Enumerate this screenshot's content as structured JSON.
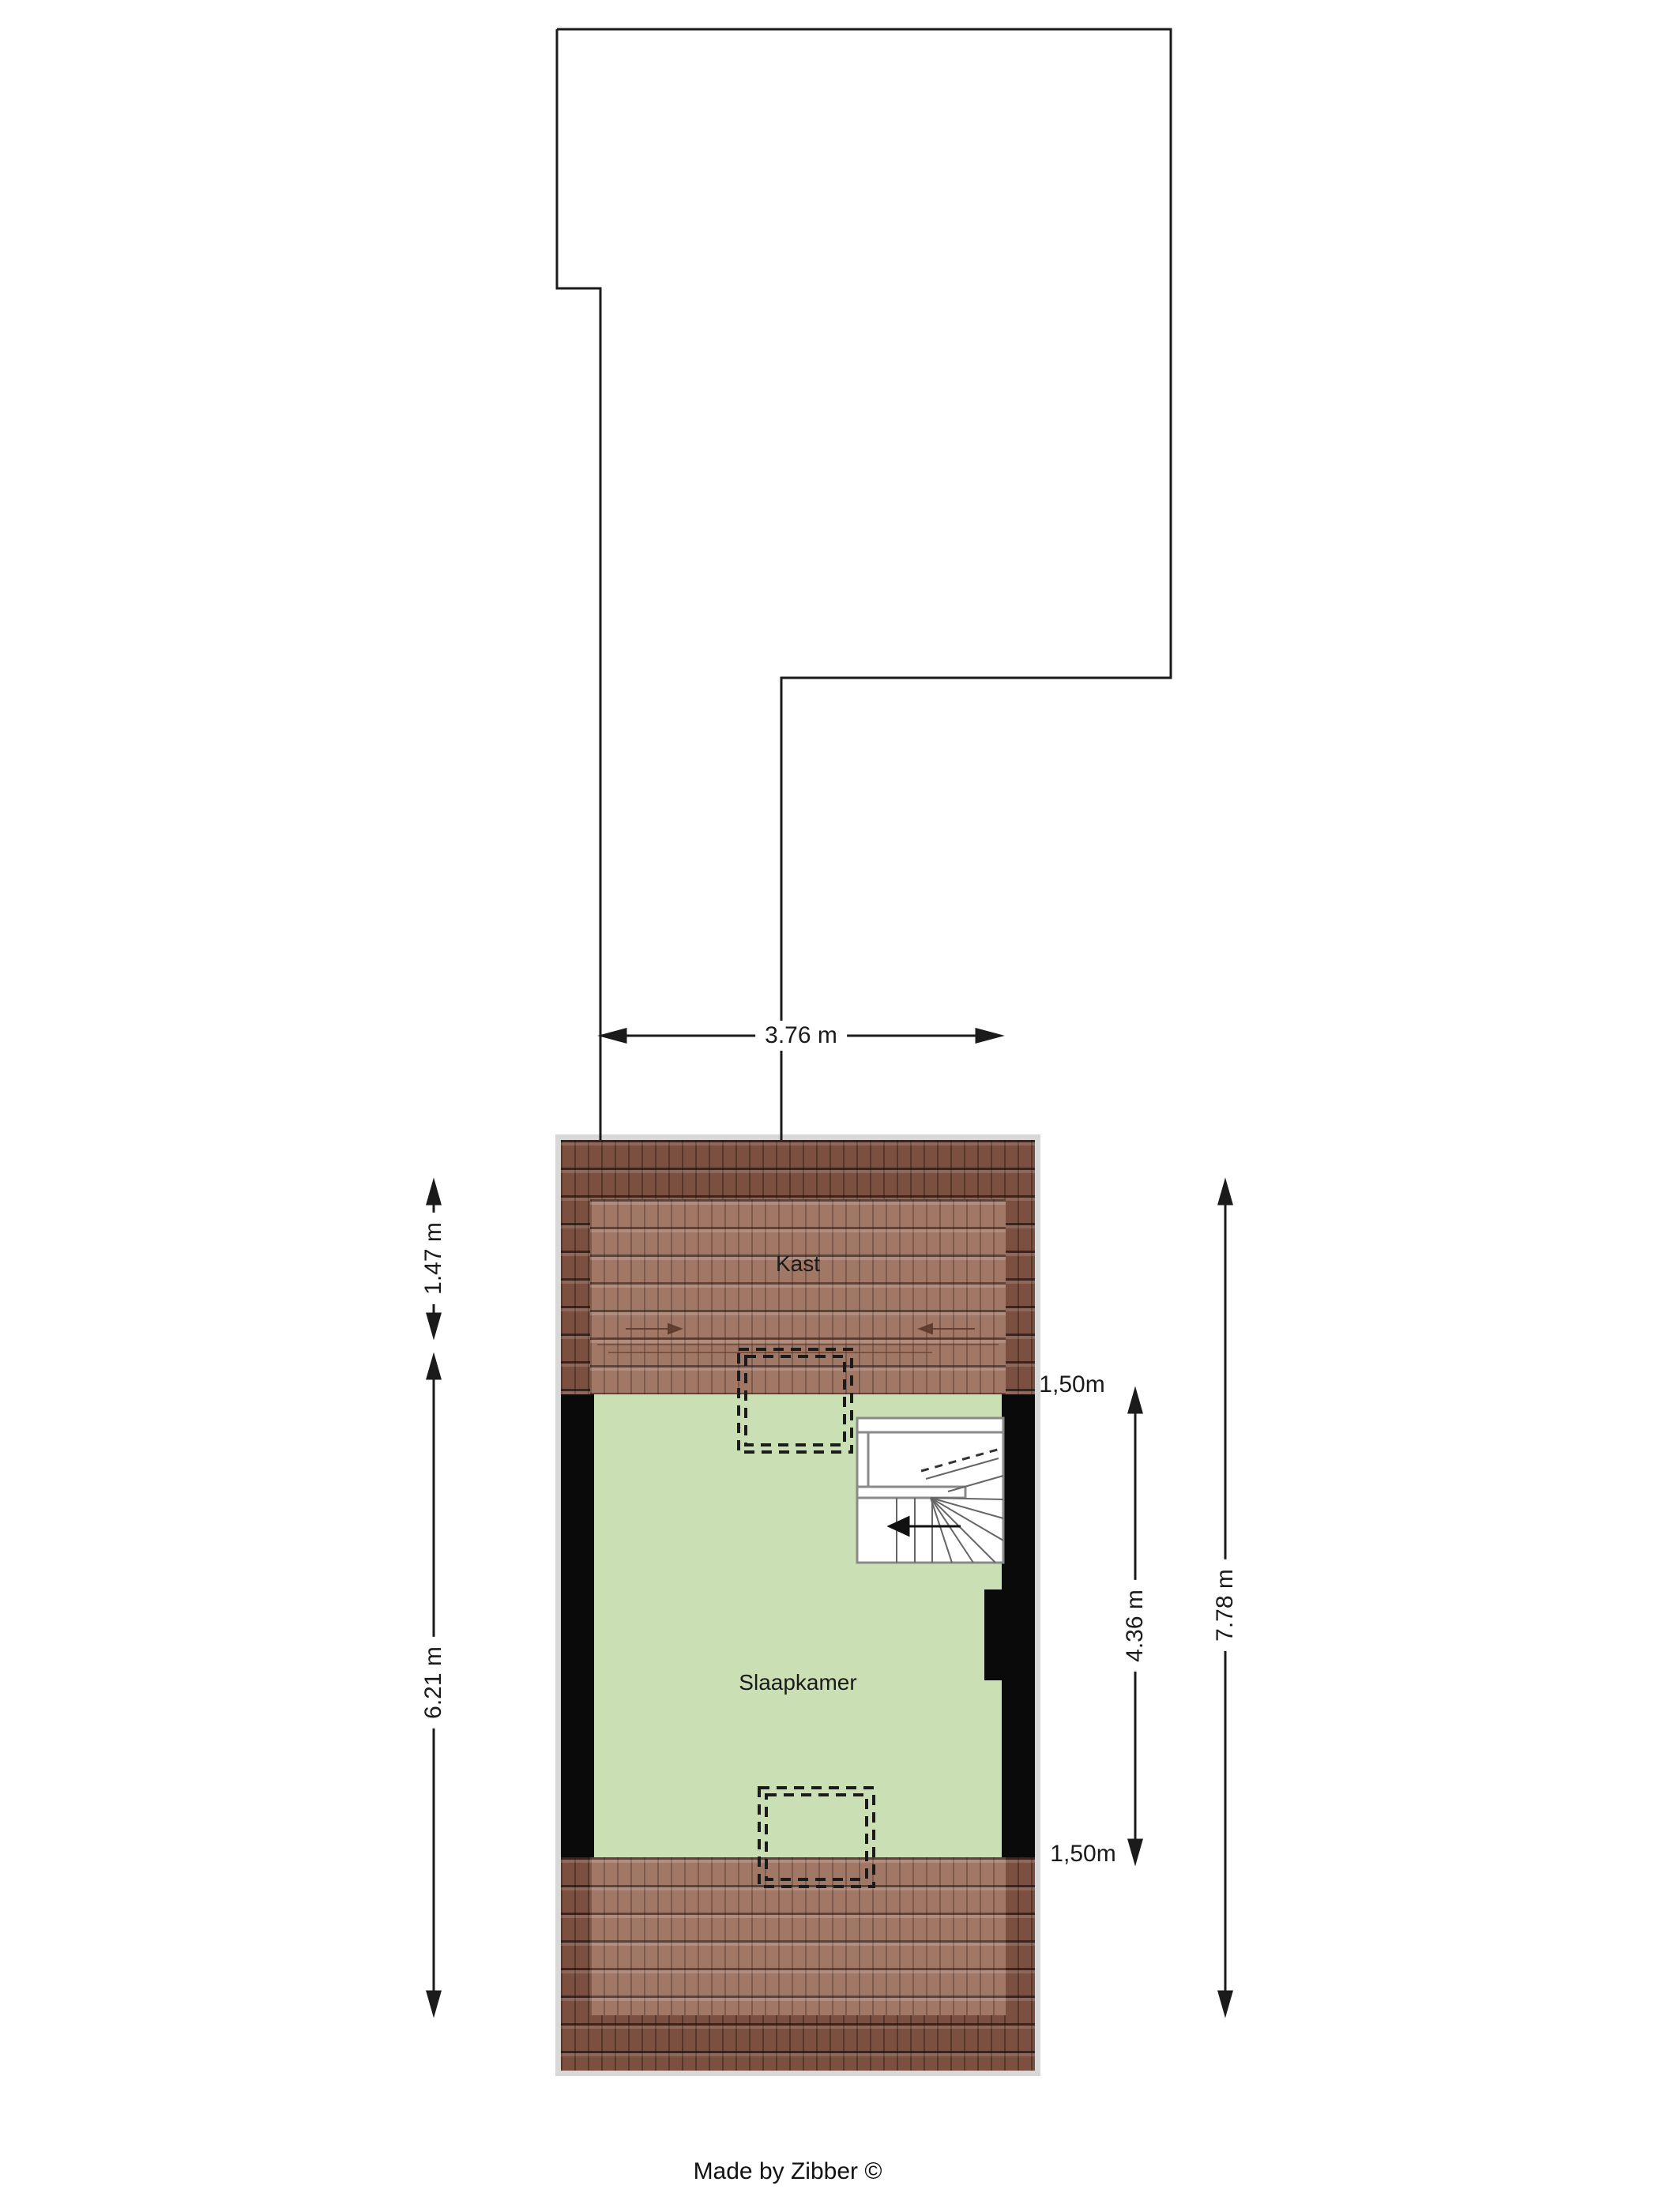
{
  "credit": "Made by Zibber ©",
  "rooms": {
    "kast": "Kast",
    "slaapkamer": "Slaapkamer"
  },
  "dimensions": {
    "roof_outline_width": "3.76 m",
    "left_upper_depth": "1.47 m",
    "left_lower_depth": "6.21 m",
    "right_room_length": "4.36 m",
    "right_total_length": "7.78 m",
    "knee_wall_top": "1,50m",
    "knee_wall_bottom": "1,50m"
  },
  "colors": {
    "floor_green": "#cadfb3",
    "tile_dark": "#7b5040",
    "tile_light": "#a1776f",
    "wall_black": "#0a0a0a",
    "line": "#1b1b1b"
  }
}
